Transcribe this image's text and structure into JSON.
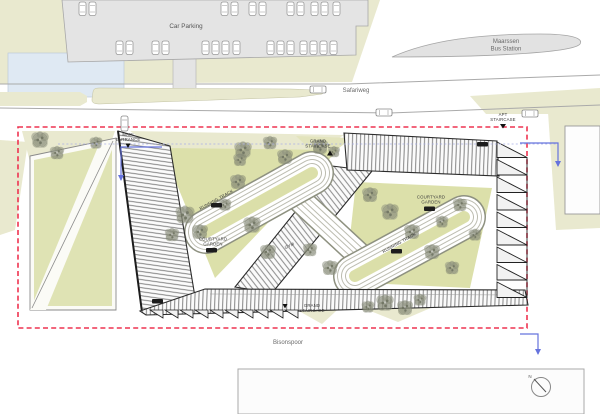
{
  "plan": {
    "streets": {
      "safariweg": "Safariweg",
      "bisonspoor": "Bisonspoor"
    },
    "parking": {
      "label": "Car Parking"
    },
    "bus_station": {
      "line1": "Maarssen",
      "line2": "Bus Station"
    },
    "labels": {
      "entrance": {
        "line1": "MAIN",
        "line2": "ENTRANCE"
      },
      "staircase_top": {
        "line1": "GRAND",
        "line2": "STAIRCASE"
      },
      "staircase_bottom": {
        "line1": "GRAND",
        "line2": "STAIRCASE"
      },
      "apt_staircase": {
        "line1": "APT",
        "line2": "STAIRCASE"
      },
      "courtyard_left": {
        "line1": "COURTYARD",
        "line2": "GARDEN"
      },
      "courtyard_right": {
        "line1": "COURTYARD",
        "line2": "GARDEN"
      },
      "running_track_upper": "RUNNING TRACK",
      "running_track_lower": "RUNNING TRACK",
      "gym": "GYM"
    },
    "compass": {
      "north": "N"
    },
    "colors": {
      "ground": "#e9e9cf",
      "courtyard": "#dce0aa",
      "parking_lot": "#e4e4e4",
      "bus_platform": "#e2e2e2",
      "boundary": "#ee3350",
      "arrows": "#6673dd",
      "tree": "#8b8f7e",
      "building_line": "#2b2b2b",
      "water": "#dfe9f3"
    }
  }
}
